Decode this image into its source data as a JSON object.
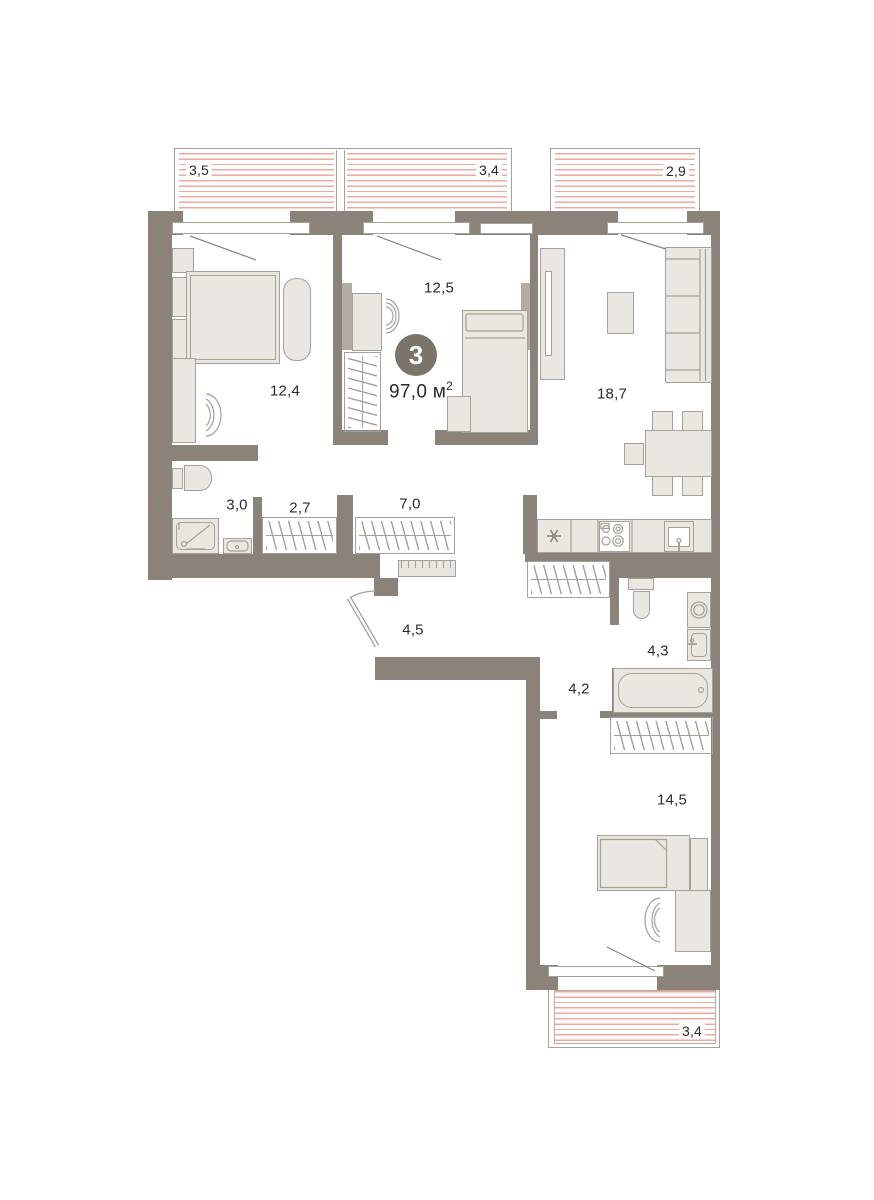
{
  "plan": {
    "type": "apartment-floor-plan",
    "badge_rooms": "3",
    "total_area": {
      "value": "97,0 м",
      "sup": "2"
    },
    "rooms": [
      {
        "name": "bedroom-1",
        "area": "12,4"
      },
      {
        "name": "bedroom-2",
        "area": "12,5"
      },
      {
        "name": "living-kitchen",
        "area": "18,7"
      },
      {
        "name": "bathroom-1",
        "area": "3,0"
      },
      {
        "name": "closet-hall-1",
        "area": "2,7"
      },
      {
        "name": "closet-hall-2",
        "area": "7,0"
      },
      {
        "name": "entry-hall",
        "area": "4,5"
      },
      {
        "name": "corridor",
        "area": "4,2"
      },
      {
        "name": "bathroom-2",
        "area": "4,3"
      },
      {
        "name": "bedroom-3",
        "area": "14,5"
      }
    ],
    "balconies": [
      {
        "name": "balcony-top-left",
        "area": "3,5"
      },
      {
        "name": "balcony-top-middle",
        "area": "3,4"
      },
      {
        "name": "balcony-top-right",
        "area": "2,9"
      },
      {
        "name": "balcony-bottom",
        "area": "3,4"
      }
    ],
    "colors": {
      "wall": "#8b8279",
      "furniture_fill": "#eae7e2",
      "furniture_stroke": "#a7a096",
      "balcony_hatch": "#efaaa0",
      "badge": "#7c746b",
      "text": "#2c2a28"
    }
  }
}
